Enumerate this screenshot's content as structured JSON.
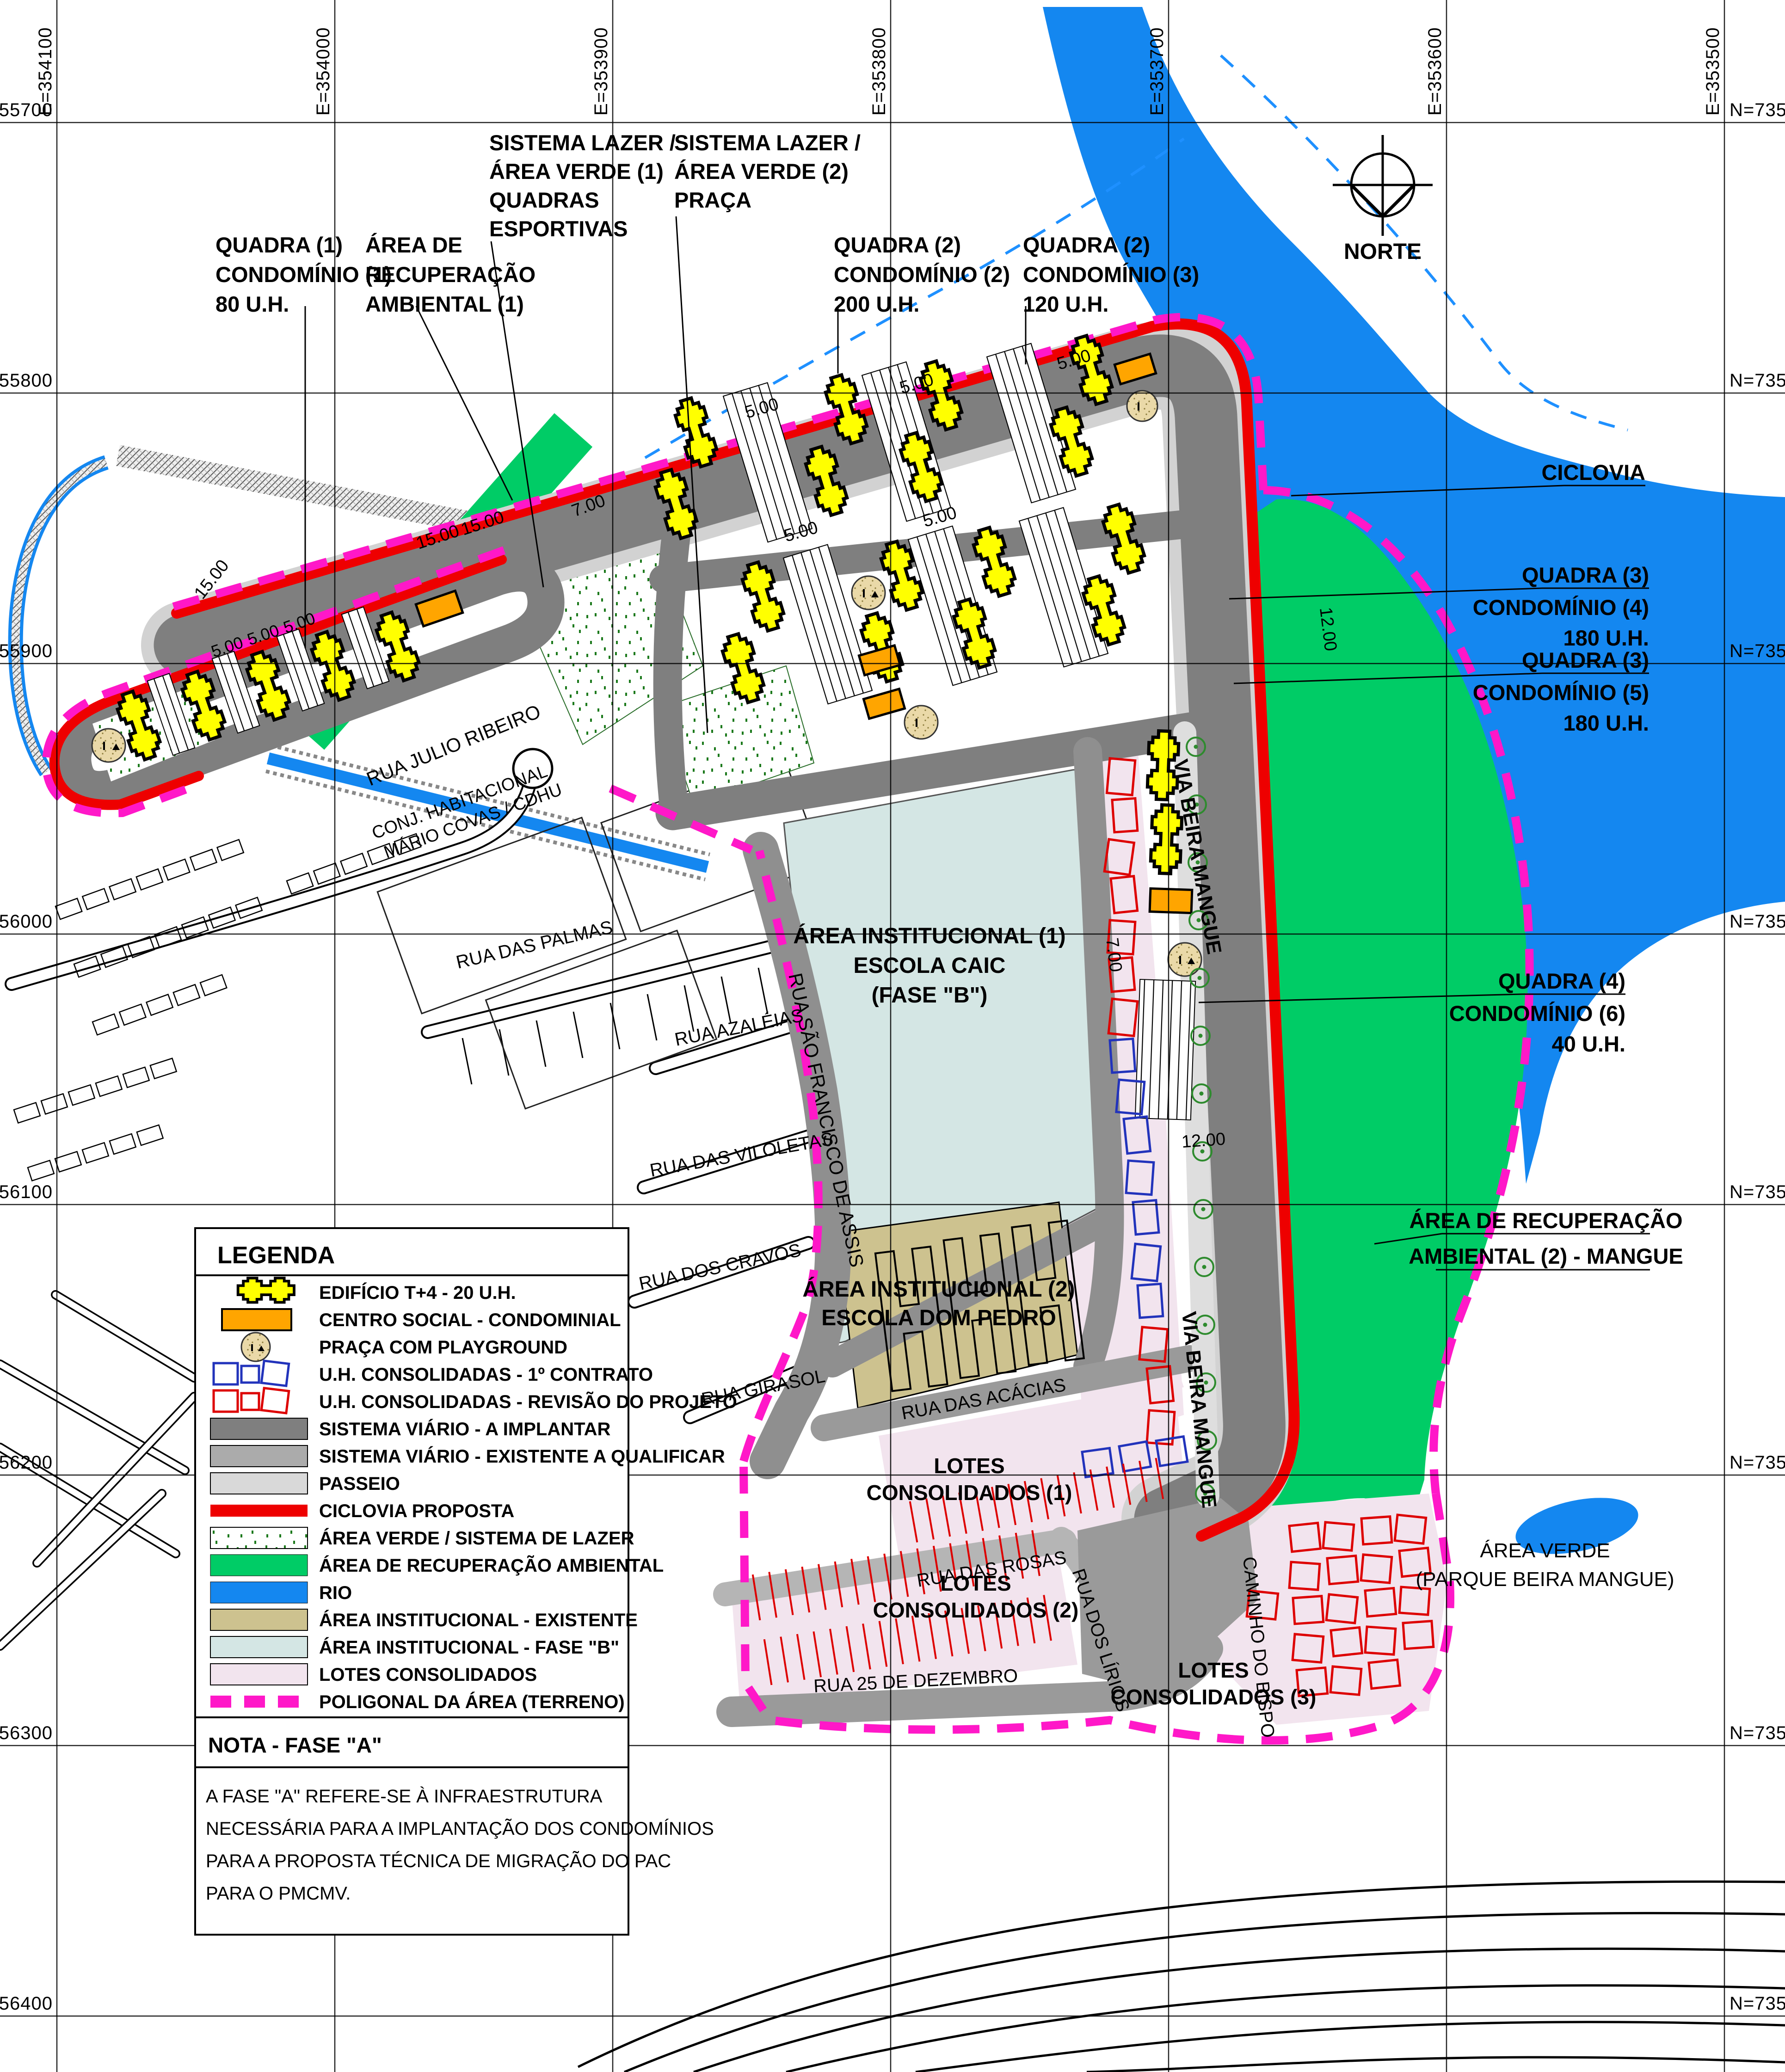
{
  "map": {
    "grid": {
      "e_labels": [
        "E=354100",
        "E=354000",
        "E=353900",
        "E=353800",
        "E=353700",
        "E=353600",
        "E=353500"
      ],
      "n_labels_left": [
        "N=7355700",
        "N=7355800",
        "N=7355900",
        "N=7356000",
        "N=7356100",
        "N=7356200",
        "N=7356300",
        "N=7356400"
      ],
      "n_labels_right": [
        "N=73557",
        "N=7355",
        "N=73559",
        "N=7356",
        "N=73561",
        "N=73562",
        "N=73563",
        "N=7356"
      ]
    },
    "compass": {
      "label": "NORTE"
    },
    "callouts": {
      "quadra1": [
        "QUADRA (1)",
        "CONDOMÍNIO (1)",
        "80 U.H."
      ],
      "recup1": [
        "ÁREA DE",
        "RECUPERAÇÃO",
        "AMBIENTAL (1)"
      ],
      "lazer1": [
        "SISTEMA LAZER /",
        "ÁREA VERDE (1)",
        "QUADRAS",
        "ESPORTIVAS"
      ],
      "lazer2": [
        "SISTEMA LAZER /",
        "ÁREA VERDE (2)",
        "PRAÇA"
      ],
      "quadra2a": [
        "QUADRA (2)",
        "CONDOMÍNIO (2)",
        "200 U.H."
      ],
      "quadra2b": [
        "QUADRA (2)",
        "CONDOMÍNIO (3)",
        "120 U.H."
      ],
      "ciclovia": "CICLOVIA",
      "quadra3a": [
        "QUADRA (3)",
        "CONDOMÍNIO (4)",
        "180 U.H."
      ],
      "quadra3b": [
        "QUADRA (3)",
        "CONDOMÍNIO (5)",
        "180 U.H."
      ],
      "quadra4": [
        "QUADRA (4)",
        "CONDOMÍNIO (6)",
        "40 U.H."
      ],
      "mangue": [
        "ÁREA DE RECUPERAÇÃO",
        "AMBIENTAL (2) - MANGUE"
      ],
      "inst1": [
        "ÁREA INSTITUCIONAL (1)",
        "ESCOLA CAIC",
        "(FASE \"B\")"
      ],
      "inst2": [
        "ÁREA INSTITUCIONAL (2)",
        "ESCOLA DOM PEDRO"
      ],
      "lotes1": [
        "LOTES",
        "CONSOLIDADOS (1)"
      ],
      "lotes2": [
        "LOTES",
        "CONSOLIDADOS (2)"
      ],
      "lotes3": [
        "LOTES",
        "CONSOLIDADOS (3)"
      ],
      "verde": [
        "ÁREA VERDE",
        "(PARQUE BEIRA MANGUE)"
      ],
      "conj": [
        "CONJ. HABITACIONAL",
        "MÁRIO COVAS / CDHU"
      ]
    },
    "streets": {
      "julio": "RUA JULIO RIBEIRO",
      "palmas": "RUA DAS PALMAS",
      "azaleias": "RUA AZALÉIAS",
      "assis": "RUA SÃO FRANCISCO DE ASSIS",
      "viloletas": "RUA DAS VILOLETAS",
      "cravos": "RUA DOS CRAVOS",
      "girasol": "RUA GIRASOL",
      "acacias": "RUA DAS ACÁCIAS",
      "rosas": "RUA DAS ROSAS",
      "lirios": "RUA DOS LÍRIOS",
      "dezembro": "RUA 25 DE DEZEMBRO",
      "bispo": "CAMINHO DO BISPO",
      "beira1": "VIA BEIRA MANGUE",
      "beira2": "VIA BEIRA MANGUE"
    },
    "dims": {
      "d5": "5.00",
      "d7": "7.00",
      "d12": "12.00",
      "d15": "15.00"
    }
  },
  "legend": {
    "title": "LEGENDA",
    "items": [
      {
        "label": "EDIFÍCIO T+4 - 20 U.H."
      },
      {
        "label": "CENTRO SOCIAL - CONDOMINIAL"
      },
      {
        "label": "PRAÇA COM PLAYGROUND"
      },
      {
        "label": "U.H. CONSOLIDADAS - 1º CONTRATO"
      },
      {
        "label": "U.H. CONSOLIDADAS - REVISÃO DO PROJETO"
      },
      {
        "label": "SISTEMA VIÁRIO - A IMPLANTAR"
      },
      {
        "label": "SISTEMA VIÁRIO - EXISTENTE A QUALIFICAR"
      },
      {
        "label": "PASSEIO"
      },
      {
        "label": "CICLOVIA PROPOSTA"
      },
      {
        "label": "ÁREA VERDE / SISTEMA DE LAZER"
      },
      {
        "label": "ÁREA DE RECUPERAÇÃO AMBIENTAL"
      },
      {
        "label": "RIO"
      },
      {
        "label": "ÁREA INSTITUCIONAL - EXISTENTE"
      },
      {
        "label": "ÁREA INSTITUCIONAL - FASE \"B\""
      },
      {
        "label": "LOTES CONSOLIDADOS"
      },
      {
        "label": "POLIGONAL DA ÁREA (TERRENO)"
      }
    ]
  },
  "nota": {
    "title": "NOTA - FASE \"A\"",
    "lines": [
      "A FASE \"A\"  REFERE-SE À INFRAESTRUTURA",
      "NECESSÁRIA PARA A IMPLANTAÇÃO DOS CONDOMÍNIOS",
      "PARA A PROPOSTA TÉCNICA DE MIGRAÇÃO DO PAC",
      "PARA O PMCMV."
    ]
  },
  "colors": {
    "road_a_implantar": "#7f7f7f",
    "road_existente": "#ababab",
    "passeio": "#d9d9d9",
    "ciclovia": "#ee0000",
    "recuperacao_ambiental": "#00cc66",
    "rio": "#1487f0",
    "inst_existente": "#cdc28f",
    "inst_fase_b": "#d4e6e4",
    "lotes_consolidados": "#f2e4ee",
    "poligonal": "#ff18c8",
    "edificio": "#ffff00",
    "centro_social": "#ffa500"
  }
}
